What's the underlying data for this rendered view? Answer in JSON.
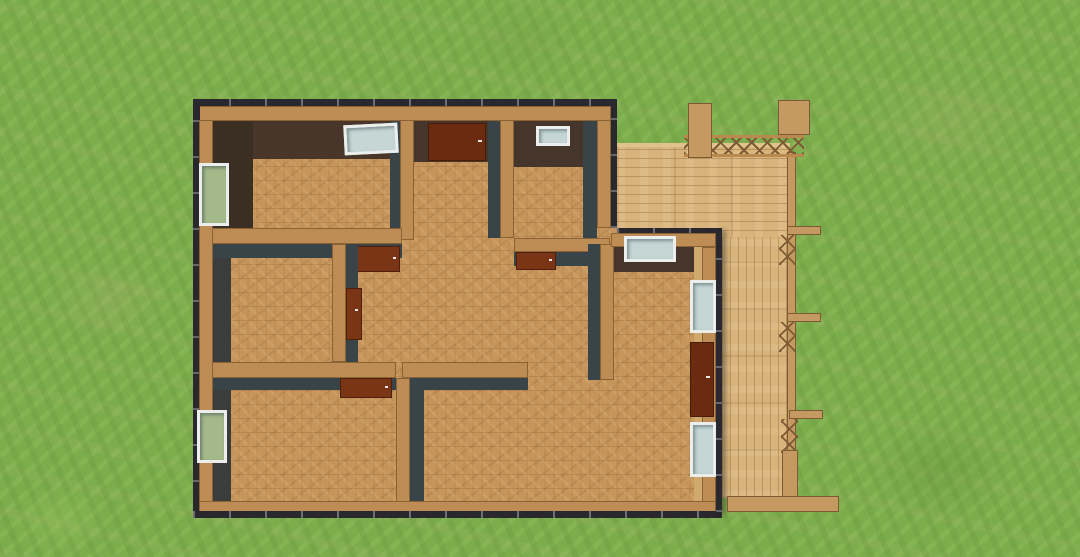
{
  "scene": {
    "type": "3d-render",
    "description": "Aerial 3D view of a single-storey house floor plan with brown parquet floors, dark walls topped with wood, white-framed windows, reddish-brown doors, and an L-shaped light-wood deck with pergola posts and cross-braced railing on a mottled grass lawn",
    "camera": "top-down, slightly oblique perspective",
    "background": "grass lawn"
  },
  "colors": {
    "grass": "#7cad4d",
    "grass-light": "#9cc468",
    "grass-dark": "#5f8c34",
    "grass-patch": "#aab06c",
    "floor": "#c6955b",
    "floor-line": "#96693c",
    "deck": "#d8b47c",
    "deck-line": "#926d3c",
    "wall-cap": "#bd8d55",
    "wall-cap-edge": "#8a6234",
    "wall-slate": "#394449",
    "wall-brown": "#45352a",
    "wall-outline": "#28282e",
    "door": "#6b2b11",
    "door-leaf": "#7a3517",
    "window-frame": "#eceeed",
    "window-glass": "#c5d6d4",
    "window-glass-green": "#a4b989",
    "timber": "#c59a62",
    "timber-dark": "#7d5a33",
    "east-wall-lit": "#cfa96e"
  },
  "inventory": {
    "rooms_visible": 7,
    "windows": 7,
    "doors": 6,
    "open_door_leaves": 4,
    "deck_sections": 2,
    "pergola_posts": 2,
    "railing_brackets": 3
  }
}
